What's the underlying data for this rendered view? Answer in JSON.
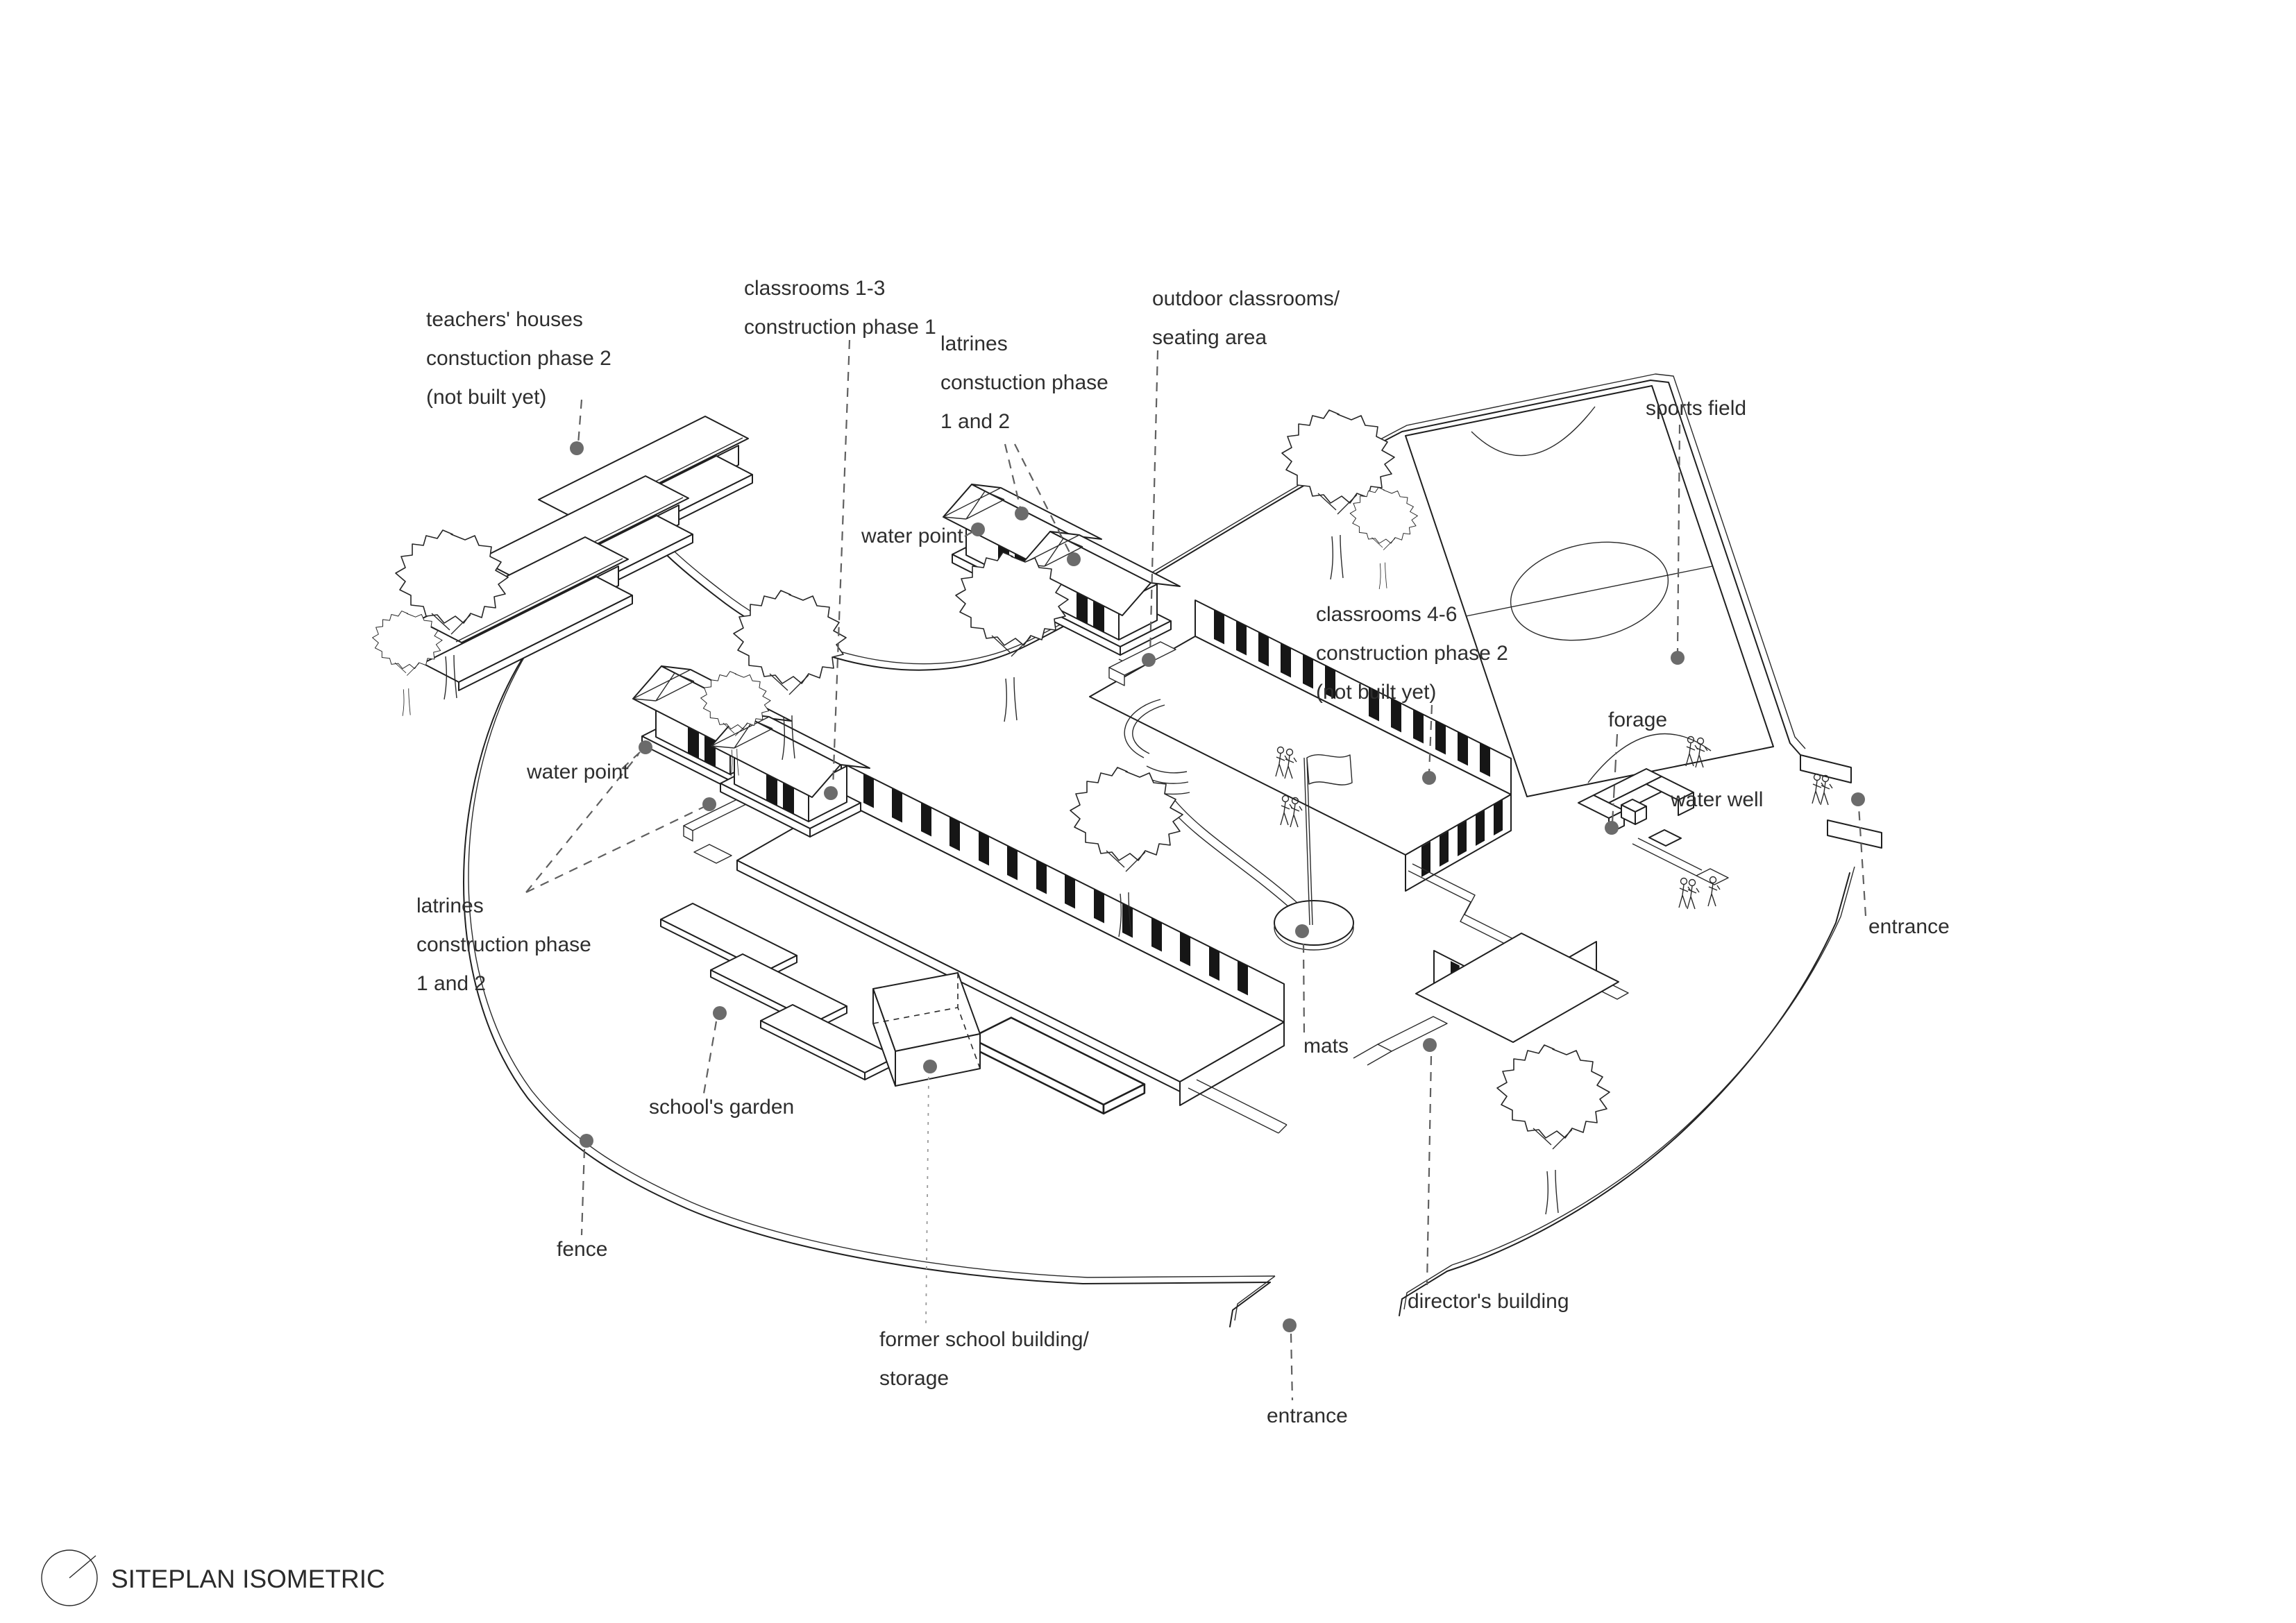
{
  "title": "SITEPLAN ISOMETRIC",
  "labels": {
    "teachers_houses": [
      "teachers' houses",
      "constuction phase 2",
      "(not built yet)"
    ],
    "classrooms_1_3": [
      "classrooms 1-3",
      "construction phase 1"
    ],
    "latrines_top": [
      "latrines",
      "constuction phase",
      "1 and 2"
    ],
    "outdoor_classrooms": [
      "outdoor classrooms/",
      "seating area"
    ],
    "sports_field": [
      "sports field"
    ],
    "water_point_center": [
      "water point"
    ],
    "classrooms_4_6": [
      "classrooms 4-6",
      "construction phase 2",
      "(not built yet)"
    ],
    "forage": [
      "forage"
    ],
    "water_well": [
      "water well"
    ],
    "entrance_right": [
      "entrance"
    ],
    "water_point_left": [
      "water point"
    ],
    "latrines_left": [
      "latrines",
      "construction phase",
      "1 and 2"
    ],
    "mats": [
      "mats"
    ],
    "schools_garden": [
      "school's garden"
    ],
    "fence": [
      "fence"
    ],
    "former_school": [
      "former school building/",
      "storage"
    ],
    "entrance_bottom": [
      "entrance"
    ],
    "directors_building": [
      "director's building"
    ]
  },
  "colors": {
    "line": "#1f1f1f",
    "leader": "#5f5f5f",
    "dot": "#6b6b6b",
    "window": "#161616",
    "background": "#ffffff"
  }
}
